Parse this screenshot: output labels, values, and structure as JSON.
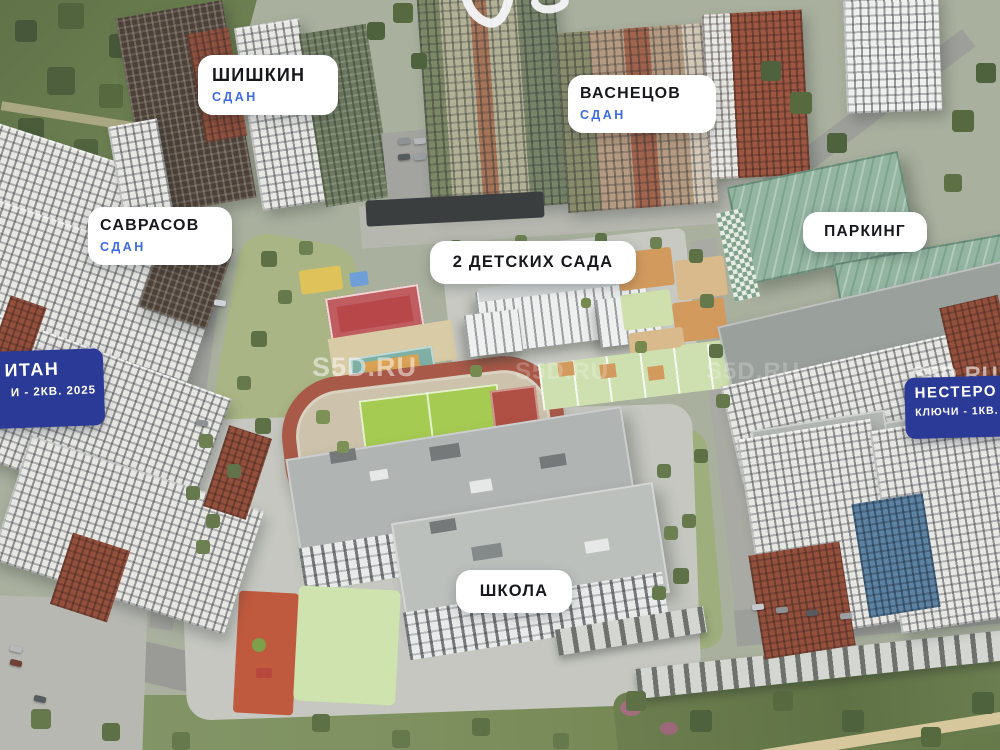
{
  "watermark": {
    "text": "S5D.RU"
  },
  "labels": {
    "shishkin": {
      "name": "ШИШКИН",
      "status": "СДАН"
    },
    "savrasov": {
      "name": "САВРАСОВ",
      "status": "СДАН"
    },
    "vasnetsov": {
      "name": "ВАСНЕЦОВ",
      "status": "СДАН"
    },
    "parking": {
      "name": "ПАРКИНГ"
    },
    "kindergartens": {
      "name": "2 ДЕТСКИХ САДА"
    },
    "school": {
      "name": "ШКОЛА"
    }
  },
  "banners": {
    "left": {
      "line1": "ИТАН",
      "line2": "И - 2КВ. 2025"
    },
    "right": {
      "line1": "НЕСТЕРО",
      "line2": "КЛЮЧИ - 1КВ."
    }
  },
  "colors": {
    "label_bg": "#ffffff",
    "label_text": "#17181c",
    "status_blue": "#3d6be0",
    "banner_blue": "#2b3a96",
    "parking_roof_green": "#93b5a1",
    "track_red": "#a85948",
    "field_green": "#a6cb52",
    "court_red": "#b8474a",
    "forest_green": "#56683f"
  }
}
